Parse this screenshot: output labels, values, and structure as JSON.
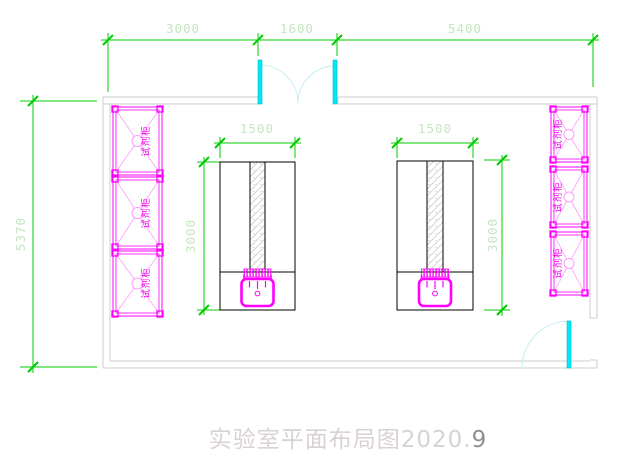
{
  "title": {
    "main": "实验室平面布局图2020.",
    "accent": "9"
  },
  "dimensions": {
    "top_left": "3000",
    "top_middle": "1600",
    "top_right": "5400",
    "left_overall": "5370",
    "bench_width": "1500",
    "bench_height": "3000"
  },
  "labels": {
    "reagent_cabinet": "试剂柜"
  },
  "colors": {
    "dimension_line": "#00cc00",
    "dimension_text": "#c4e6c0",
    "cabinet_magenta": "#ff00ff",
    "door_cyan": "#00eaf5",
    "door_arc_cyan": "#c4eef4",
    "wall_gray": "#cccccc",
    "bench_line": "#000000",
    "title_gray": "#d8d2d2"
  }
}
